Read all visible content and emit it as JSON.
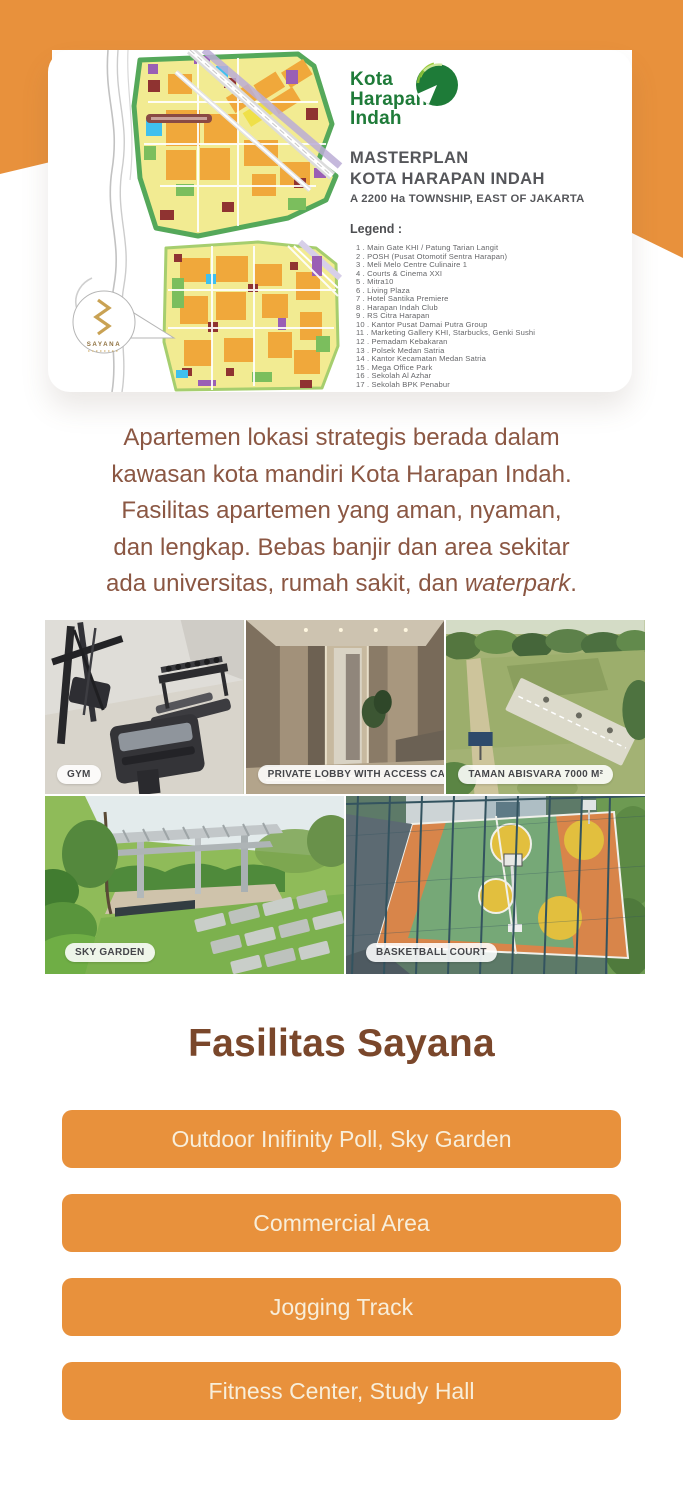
{
  "theme": {
    "accent_orange": "#E8913C",
    "logo_green": "#1F7B39",
    "paragraph_brown": "#8B5743",
    "heading_brown": "#7A472B",
    "button_text_cream": "#F8EEDA"
  },
  "masterplan_card": {
    "logo": {
      "line1": "Kota",
      "line2": "Harapan",
      "line3": "Indah"
    },
    "title_line1": "MASTERPLAN",
    "title_line2": "KOTA HARAPAN INDAH",
    "subtitle": "A 2200 Ha TOWNSHIP, EAST OF JAKARTA",
    "legend_title": "Legend :",
    "legend_items": [
      "1 . Main Gate KHI / Patung Tarian Langit",
      "2 . POSH (Pusat Otomotif Sentra Harapan)",
      "3 . Meli Melo Centre Culinaire 1",
      "4 . Courts & Cinema XXI",
      "5 . Mitra10",
      "6 . Living Plaza",
      "7 . Hotel Santika Premiere",
      "8 . Harapan Indah Club",
      "9 . RS Citra Harapan",
      "10 . Kantor Pusat Damai Putra Group",
      "11 . Marketing Gallery KHI, Starbucks, Genki Sushi",
      "12 . Pemadam Kebakaran",
      "13 . Polsek Medan Satria",
      "14 . Kantor Kecamatan Medan Satria",
      "15 . Mega Office Park",
      "16 . Sekolah Al Azhar",
      "17 . Sekolah BPK Penabur"
    ],
    "map_callout_brand": "SAYANA"
  },
  "description": {
    "lines": [
      "Apartemen lokasi strategis berada dalam",
      "kawasan kota mandiri Kota Harapan Indah.",
      "Fasilitas apartemen yang aman, nyaman,",
      "dan lengkap. Bebas banjir dan area sekitar"
    ],
    "line5_prefix": "ada universitas, rumah sakit, dan ",
    "italic_word": "waterpark",
    "suffix": "."
  },
  "gallery": {
    "photos": [
      {
        "label": "GYM"
      },
      {
        "label": "PRIVATE LOBBY WITH ACCESS CARD"
      },
      {
        "label": "TAMAN ABISVARA 7000 M²"
      },
      {
        "label": "SKY GARDEN"
      },
      {
        "label": "BASKETBALL COURT"
      }
    ]
  },
  "facilities": {
    "heading": "Fasilitas Sayana",
    "buttons": [
      {
        "label": "Outdoor Inifinity Poll, Sky Garden"
      },
      {
        "label": "Commercial Area"
      },
      {
        "label": "Jogging Track"
      },
      {
        "label": "Fitness Center, Study Hall"
      }
    ]
  }
}
